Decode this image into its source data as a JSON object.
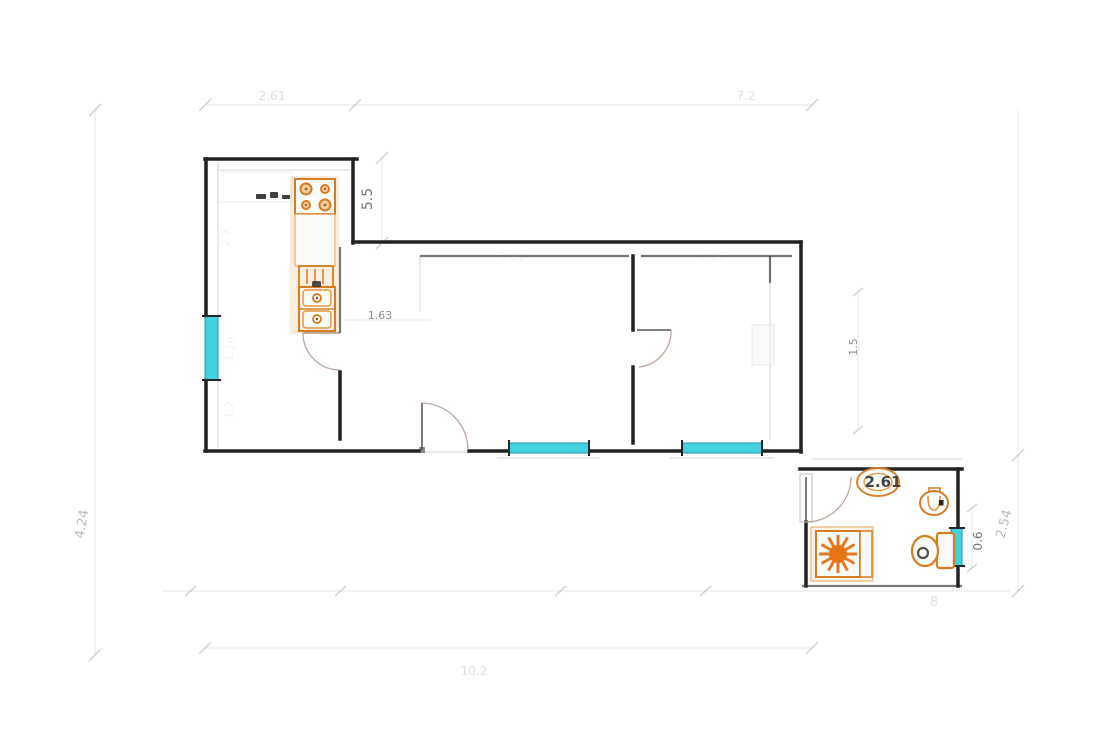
{
  "plan": {
    "title": "apartment-floor-plan",
    "colors": {
      "wall": "#1f1f1f",
      "fixture_orange": "#d97c1e",
      "window_cyan": "#3fd4e4",
      "dimension_gray": "#9a9a9a",
      "background": "#ffffff"
    },
    "labels": {
      "dim_top_left": "2.61",
      "dim_top_right": "7.2",
      "dim_kitchen_height": "5.5",
      "dim_left_height": "4.24",
      "dim_kitchen_a": "2.7",
      "dim_kitchen_b": "1.19",
      "dim_kitchen_c": "1.2",
      "dim_hallway": "1.63",
      "dim_living_width": "3.61",
      "dim_bedroom_width": "2.95",
      "dim_bedroom_side": "1.5",
      "dim_bath_width": "2.61",
      "dim_bath_window": "0.6",
      "dim_bath_height": "2.54",
      "dim_bottom_span": "10.2",
      "misc_glyph": "8"
    },
    "fixtures": [
      "stove-hob-4-burners",
      "kitchen-counter",
      "kitchen-drainer",
      "kitchen-double-sink",
      "kitchen-faucet",
      "washbasin",
      "bidet",
      "toilet",
      "shower-tray-sunburst"
    ],
    "windows": [
      {
        "name": "kitchen-window",
        "wall": "west"
      },
      {
        "name": "living-room-window",
        "wall": "south"
      },
      {
        "name": "bedroom-window",
        "wall": "south"
      },
      {
        "name": "bathroom-window",
        "wall": "east"
      }
    ],
    "doors": [
      "kitchen-door",
      "entry-door",
      "bedroom-door",
      "bathroom-door"
    ]
  }
}
